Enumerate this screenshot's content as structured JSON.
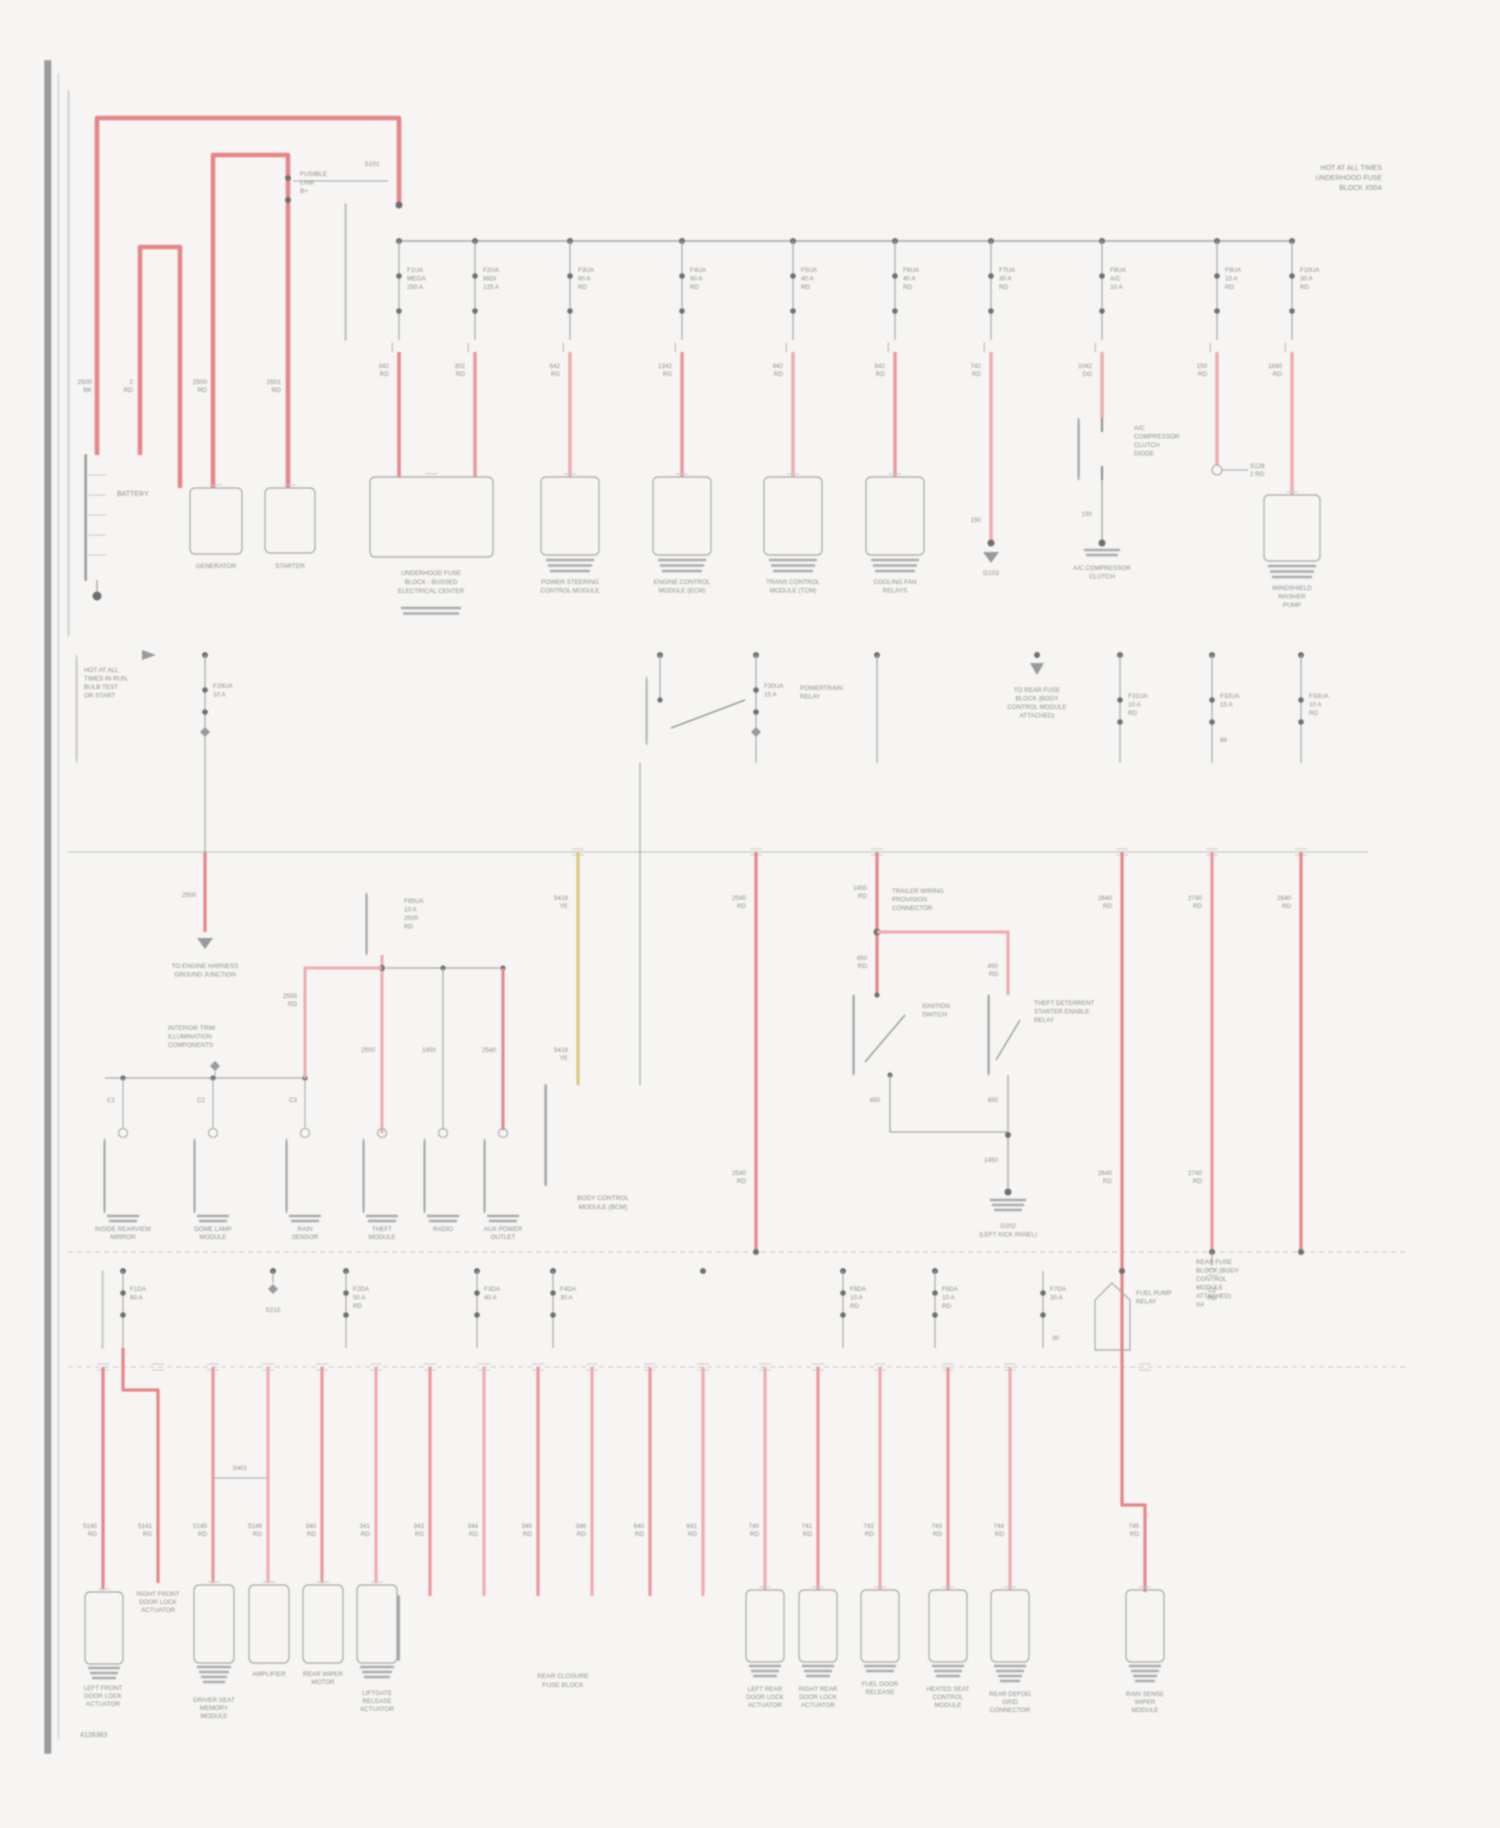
{
  "page": {
    "top_right_note": [
      "HOT AT ALL TIMES",
      "UNDERHOOD FUSE",
      "BLOCK X50A"
    ],
    "corner_note": "4128383"
  },
  "band1": {
    "battery_label": [
      "BATTERY"
    ],
    "feed_wire_labels": [
      [
        "2500",
        "BK"
      ],
      [
        "2",
        "RD"
      ],
      [
        "2500",
        "RD"
      ],
      [
        "2501",
        "RD"
      ]
    ],
    "fusible_link": [
      "FUSIBLE",
      "LINK",
      "B+"
    ],
    "fusible_tag": "S101",
    "generator_label": [
      "GENERATOR"
    ],
    "starter_label": [
      "STARTER"
    ],
    "fuses": [
      {
        "lines": [
          "F1UA",
          "MEGA",
          "250 A"
        ]
      },
      {
        "lines": [
          "F2UA",
          "MIDI",
          "125 A"
        ]
      },
      {
        "lines": [
          "F3UA",
          "60 A",
          "RD"
        ]
      },
      {
        "lines": [
          "F4UA",
          "60 A",
          "RD"
        ]
      },
      {
        "lines": [
          "F5UA",
          "40 A",
          "RD"
        ]
      },
      {
        "lines": [
          "F6UA",
          "40 A",
          "RD"
        ]
      },
      {
        "lines": [
          "F7UA",
          "30 A",
          "RD"
        ]
      },
      {
        "lines": [
          "F8UA",
          "A/C",
          "10 A"
        ]
      },
      {
        "lines": [
          "F9UA",
          "15 A",
          "RD"
        ]
      },
      {
        "lines": [
          "F10UA",
          "30 A",
          "RD"
        ]
      }
    ],
    "wire_labels": [
      [
        "342",
        "RD"
      ],
      [
        "302",
        "RD"
      ],
      [
        "542",
        "RD"
      ],
      [
        "1342",
        "RD"
      ],
      [
        "442",
        "RD"
      ],
      [
        "642",
        "RD"
      ],
      [
        "742",
        "RD"
      ],
      [
        "1042",
        "DG"
      ],
      [
        "150",
        "RD"
      ],
      [
        "1840",
        "RD"
      ]
    ],
    "comp_wide": [
      "UNDERHOOD FUSE",
      "BLOCK - BUSSED",
      "ELECTRICAL CENTER"
    ],
    "comp_labels": [
      [
        "POWER STEERING",
        "CONTROL MODULE"
      ],
      [
        "ENGINE CONTROL",
        "MODULE (ECM)"
      ],
      [
        "TRANS CONTROL",
        "MODULE (TCM)"
      ],
      [
        "COOLING FAN",
        "RELAYS"
      ]
    ],
    "g103_wire": "150",
    "g103": "G103",
    "ac_diode": [
      "A/C",
      "COMPRESSOR",
      "CLUTCH",
      "DIODE"
    ],
    "ac_under": [
      "A/C COMPRESSOR",
      "CLUTCH"
    ],
    "s128": [
      "S128",
      "2 RD"
    ],
    "washer": [
      "WINDSHIELD",
      "WASHER",
      "PUMP"
    ]
  },
  "band2": {
    "left_note": [
      "HOT AT ALL",
      "TIMES IN RUN,",
      "BULB TEST",
      "OR START"
    ],
    "f29": [
      "F29UA",
      "10 A"
    ],
    "w205": "2500",
    "gnd_note": [
      "TO ENGINE HARNESS",
      "GROUND JUNCTION"
    ],
    "relay_label": [
      "POWERTRAIN",
      "RELAY"
    ],
    "f30": [
      "F30UA",
      "15 A"
    ],
    "note1037": [
      "TO REAR FUSE",
      "BLOCK (BODY",
      "CONTROL MODULE",
      "ATTACHED)"
    ],
    "f31": [
      "F31UA",
      "10 A",
      "RD"
    ],
    "f32": [
      "F32UA",
      "15 A"
    ],
    "f32_sub": "86",
    "f33": [
      "F33UA",
      "10 A",
      "RD"
    ]
  },
  "band3": {
    "note_block": [
      "INTERIOR TRIM",
      "ILLUMINATION",
      "COMPONENTS"
    ],
    "j_labels": [
      "C1",
      "C2",
      "C3"
    ],
    "f85_block": [
      "F85UA",
      "10 A",
      "2500",
      "RD"
    ],
    "w307": [
      "2500",
      "RD"
    ],
    "w382": "2500",
    "w443": "1450",
    "w503": "2540",
    "w578a": [
      "5418",
      "YE"
    ],
    "w578b": [
      "5418",
      "YE"
    ],
    "comps": [
      [
        "INSIDE REARVIEW",
        "MIRROR"
      ],
      [
        "DOME LAMP",
        "MODULE"
      ],
      [
        "RAIN",
        "SENSOR"
      ],
      [
        "THEFT",
        "MODULE"
      ],
      [
        "RADIO",
        ""
      ],
      [
        "AUX POWER",
        "OUTLET"
      ]
    ],
    "bcm": [
      "BODY CONTROL",
      "MODULE (BCM)"
    ],
    "w877l": [
      "1450",
      "RD"
    ],
    "pnp": [
      "TRAILER WIRING",
      "PROVISION",
      "CONNECTOR"
    ],
    "w1010": [
      "450",
      "RD"
    ],
    "w877b": [
      "450",
      "RD"
    ],
    "sw1": [
      "IGNITION",
      "SWITCH"
    ],
    "sw2": [
      "THEFT DETERRENT",
      "STARTER ENABLE",
      "RELAY"
    ],
    "w890": "450",
    "w1008a": "450",
    "w1008b": "1450",
    "g202": [
      "G202",
      "(LEFT KICK PANEL)"
    ],
    "run_labels": [
      [
        "2540",
        "RD"
      ],
      [
        "2640",
        "RD"
      ],
      [
        "2740",
        "RD"
      ],
      [
        "2840",
        "RD"
      ]
    ]
  },
  "band4": {
    "fuses": [
      {
        "lines": [
          "F1DA",
          "60 A"
        ]
      },
      {
        "lines": [
          "F2DA",
          "50 A",
          "RD"
        ]
      },
      {
        "lines": [
          "F3DA",
          "40 A"
        ]
      },
      {
        "lines": [
          "F4DA",
          "30 A"
        ]
      },
      {
        "lines": [
          "F5DA",
          "10 A",
          "RD"
        ]
      },
      {
        "lines": [
          "F6DA",
          "10 A",
          "RD"
        ]
      },
      {
        "lines": [
          "F7DA",
          "30 A"
        ]
      }
    ],
    "s_tap": "S210",
    "f7sub": "30",
    "pump": [
      "FUEL PUMP",
      "RELAY"
    ],
    "c1212": [
      "C2",
      "RD"
    ],
    "right_note": [
      "REAR FUSE",
      "BLOCK (BODY",
      "CONTROL",
      "MODULE",
      "ATTACHED)",
      "X4"
    ]
  },
  "band5": {
    "splice": "S401",
    "wire_labels": [
      [
        "5140",
        "RD"
      ],
      [
        "5141",
        "RD"
      ],
      [
        "5145",
        "RD"
      ],
      [
        "5146",
        "RD"
      ],
      [
        "340",
        "RD"
      ],
      [
        "341",
        "RD"
      ],
      [
        "343",
        "RD"
      ],
      [
        "344",
        "RD"
      ],
      [
        "345",
        "RD"
      ],
      [
        "346",
        "RD"
      ],
      [
        "640",
        "RD"
      ],
      [
        "641",
        "RD"
      ],
      [
        "740",
        "RD"
      ],
      [
        "741",
        "RD"
      ],
      [
        "742",
        "RD"
      ],
      [
        "743",
        "RD"
      ],
      [
        "744",
        "RD"
      ],
      [
        "745",
        "RD"
      ]
    ],
    "c1": [
      "LEFT FRONT",
      "DOOR LOCK",
      "ACTUATOR"
    ],
    "note158": [
      "RIGHT FRONT",
      "DOOR LOCK",
      "ACTUATOR"
    ],
    "c2": [
      "DRIVER SEAT",
      "MEMORY",
      "MODULE"
    ],
    "c3": [
      "AMPLIFIER"
    ],
    "c4": [
      "REAR WIPER",
      "MOTOR"
    ],
    "c5": [
      "LIFTGATE",
      "RELEASE",
      "ACTUATOR"
    ],
    "rear_block": [
      "REAR CLOSURE",
      "FUSE BLOCK"
    ],
    "c6": [
      "LEFT REAR",
      "DOOR LOCK",
      "ACTUATOR"
    ],
    "c7": [
      "RIGHT REAR",
      "DOOR LOCK",
      "ACTUATOR"
    ],
    "c8": [
      "FUEL DOOR",
      "RELEASE"
    ],
    "c9": [
      "HEATED SEAT",
      "CONTROL",
      "MODULE"
    ],
    "c10": [
      "REAR DEFOG",
      "GRID",
      "CONNECTOR"
    ],
    "c11": [
      "RAIN SENSE",
      "WIPER",
      "MODULE"
    ]
  }
}
